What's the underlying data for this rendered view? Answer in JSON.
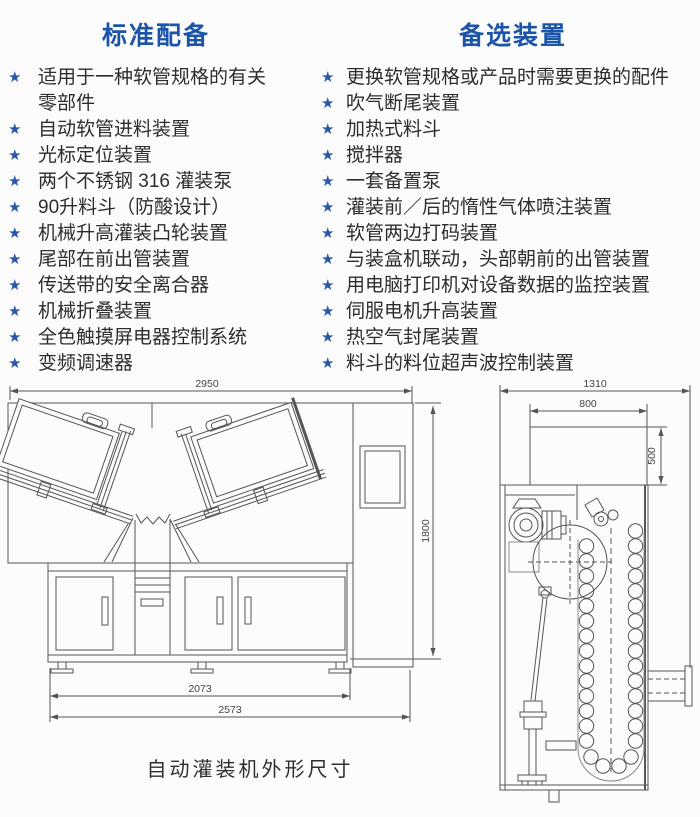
{
  "icons": {
    "star": "★"
  },
  "colors": {
    "title_blue": "#1b54a8",
    "star_blue": "#2a57a6",
    "text": "#2d2d2d",
    "line": "#555555"
  },
  "standard": {
    "title": "标准配备",
    "items": [
      "适用于一种软管规格的有关零部件",
      "自动软管进料装置",
      "光标定位装置",
      "两个不锈钢 316 灌装泵",
      "90升料斗（防酸设计）",
      "机械升高灌装凸轮装置",
      "尾部在前出管装置",
      "传送带的安全离合器",
      "机械折叠装置",
      "全色触摸屏电器控制系统",
      "变频调速器"
    ]
  },
  "optional": {
    "title": "备选装置",
    "items": [
      "更换软管规格或产品时需要更换的配件",
      "吹气断尾装置",
      "加热式料斗",
      "搅拌器",
      "一套备置泵",
      "灌装前／后的惰性气体喷注装置",
      "软管两边打码装置",
      "与装盒机联动，头部朝前的出管装置",
      "用电脑打印机对设备数据的监控装置",
      "伺服电机升高装置",
      "热空气封尾装置",
      "料斗的料位超声波控制装置"
    ]
  },
  "drawing": {
    "caption": "自动灌装机外形尺寸",
    "front_view": {
      "width_top": "2950",
      "height": "1800",
      "width_inner": "2073",
      "width_overall": "2573"
    },
    "top_view": {
      "depth_overall": "1310",
      "rear_width": "800",
      "rear_height": "500"
    }
  }
}
